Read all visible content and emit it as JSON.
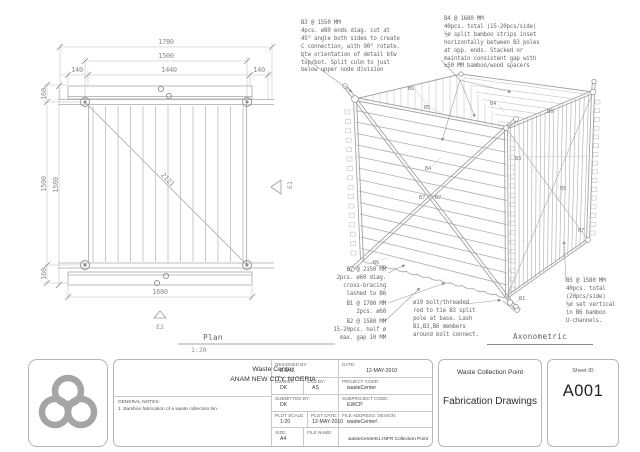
{
  "plan": {
    "title": "Plan",
    "scale": "1:20",
    "dims": {
      "d1780": "1780",
      "d1500_top": "1500",
      "d1440": "1440",
      "d140_l": "140",
      "d140_r": "140",
      "d160_t": "160",
      "d1500_left": "1500",
      "d1580": "1580",
      "d160_b": "160",
      "d2121": "2121",
      "d1680": "1680"
    },
    "markers": {
      "e1": "E1",
      "e2": "E2"
    }
  },
  "axon": {
    "title": "Axonometric",
    "labels": {
      "b6_top": "B6",
      "b5_top": "B5",
      "b4_top": "B4",
      "b6_right": "B6",
      "b3_right": "B3",
      "b4_mid": "B4",
      "b7_x1": "B7",
      "b7_x2": "B7",
      "b5_right": "B5",
      "b7_br": "B7",
      "b1_bottom": "B1",
      "b6_bl": "B6"
    },
    "notes": {
      "b3": "B3 @ 1550 MM\n4pcs. ø80 ends diag. cut at\n45° angle both sides to create\nC connection, with 90° rotate.\nbtw orientation of detail btw\ntop/bot. Split culm to just\nbelow upper node division",
      "b4": "B4 @ 1680 MM\n40pcs. total (15-20pcs/side)\n½ø split bamboo strips inset\nhorizontally between B3 poles\nat opp. ends. Stacked or\nmaintain consistent gap with\n±50 MM bamboo/wood spacers",
      "b7": "B7 @ 2150 MM\n2pcs. ø60 diag.\ncross-bracing\nlashed to B6",
      "b1": "B1 @ 1780 MM\n2pcs. ø60",
      "b2": "B2 @ 1580 MM\n15-20pcs. half ø\nmax. gap 10 MM",
      "bolt": "ø19 bolt/threaded\nrod to tie B3 split\npole at base. Lash\nB1,B3,B6 members\naround bolt connect.",
      "b5": "B5 @ 1580 MM\n40pcs. total\n(20pcs/side)\n½ø set vertical\nin B6 bamboo\nU-channels."
    }
  },
  "titleblock": {
    "project_name": "Waste Center",
    "project_location": "ANAM NEW CITY, NIGERIA",
    "general_notes_label": "GENERAL NOTES:",
    "general_notes": "1. Bamboo fabrication of a waste collection bin.",
    "designed_by_label": "DESIGNED BY:",
    "designed_by": "E.U.U.",
    "date_label": "DATE:",
    "date": "12-MAY-2010",
    "dwn_by_label": "DWN BY:",
    "dwn_by": "DK",
    "ckd_by_label": "CKD BY:",
    "ckd_by": "AS",
    "project_code_label": "PROJECT CODE:",
    "project_code": "wasteCenter",
    "submitted_by_label": "SUBMITTED BY:",
    "submitted_by": "DK",
    "subproject_code_label": "SUBPROJECT CODE:",
    "subproject_code": "EWCP",
    "plot_scale_label": "PLOT SCALE:",
    "plot_scale": "1:20",
    "plot_date_label": "PLOT DATE:",
    "plot_date": "12-MAY-2010",
    "file_address_label": "FILE ADDRESS: DESIGN:",
    "file_address": "wasteCenter\\",
    "size_label": "SIZE:",
    "size": "A4",
    "file_name_label": "FILE NAME:",
    "file_name": "wasteCenterE1.INFR Collection Point",
    "sheet_title_top": "Waste Collection Point",
    "sheet_title_main": "Fabrication Drawings",
    "sheet_id_label": "Sheet ID",
    "sheet_id": "A001"
  }
}
